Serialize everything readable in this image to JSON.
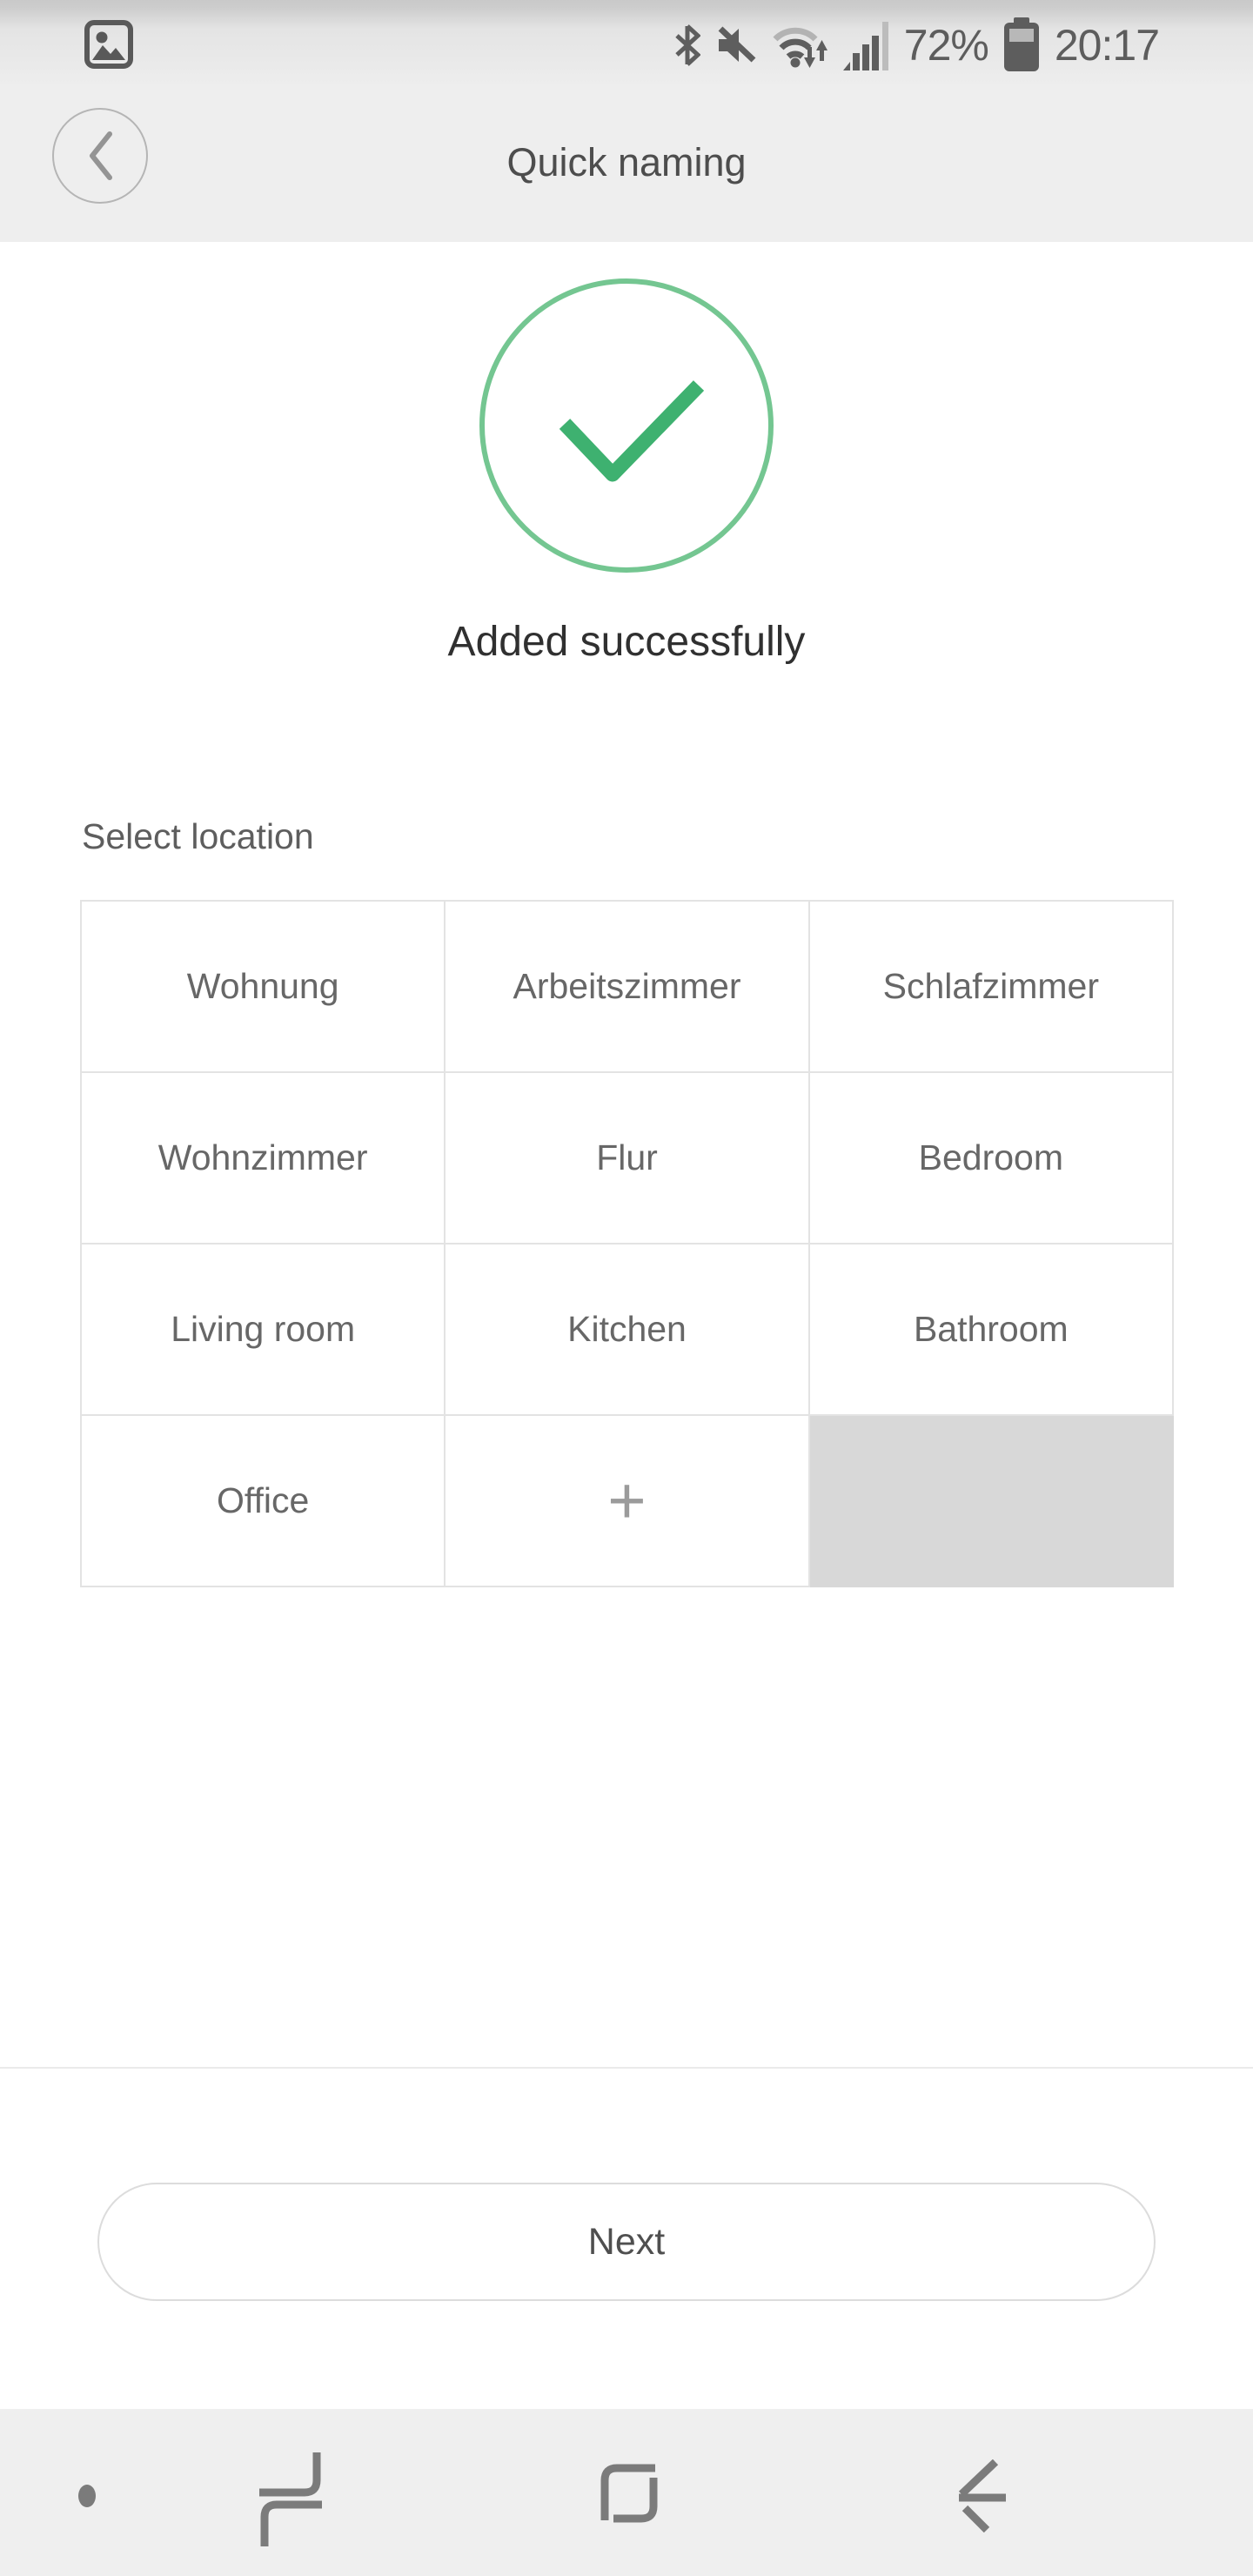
{
  "status_bar": {
    "time": "20:17",
    "battery_percent": "72%",
    "left_icons": [
      {
        "name": "screenshot-notification-icon"
      }
    ],
    "right_icons": [
      {
        "name": "bluetooth-icon"
      },
      {
        "name": "mute-icon"
      },
      {
        "name": "wifi-traffic-icon"
      },
      {
        "name": "signal-strength-icon"
      },
      {
        "name": "battery-icon"
      }
    ]
  },
  "header": {
    "title": "Quick naming",
    "back_icon": "chevron-left-icon"
  },
  "main": {
    "success_icon": "green-check-circle-icon",
    "success_message": "Added successfully",
    "select_location_label": "Select location",
    "grid": {
      "cells": [
        {
          "label": "Wohnung",
          "type": "location"
        },
        {
          "label": "Arbeitszimmer",
          "type": "location"
        },
        {
          "label": "Schlafzimmer",
          "type": "location"
        },
        {
          "label": "Wohnzimmer",
          "type": "location"
        },
        {
          "label": "Flur",
          "type": "location"
        },
        {
          "label": "Bedroom",
          "type": "location"
        },
        {
          "label": "Living room",
          "type": "location"
        },
        {
          "label": "Kitchen",
          "type": "location"
        },
        {
          "label": "Bathroom",
          "type": "location"
        },
        {
          "label": "Office",
          "type": "location"
        },
        {
          "label": "+",
          "type": "add"
        },
        {
          "label": "",
          "type": "placeholder"
        }
      ]
    },
    "next_button_label": "Next"
  },
  "nav_bar": {
    "icons": [
      {
        "name": "hide-navbar-dot"
      },
      {
        "name": "recent-apps-icon"
      },
      {
        "name": "home-icon"
      },
      {
        "name": "back-icon"
      }
    ]
  },
  "colors": {
    "accent_check_green": "#3eb170",
    "circle_outline_green": "#74c691",
    "header_bg": "#eeeeee",
    "nav_bar_bg": "#efefef",
    "grid_border": "#e3e3e3",
    "placeholder_cell": "#d8d8d8",
    "status_text": "#5d5d5d",
    "primary_text": "#303030",
    "secondary_text": "#676767"
  }
}
